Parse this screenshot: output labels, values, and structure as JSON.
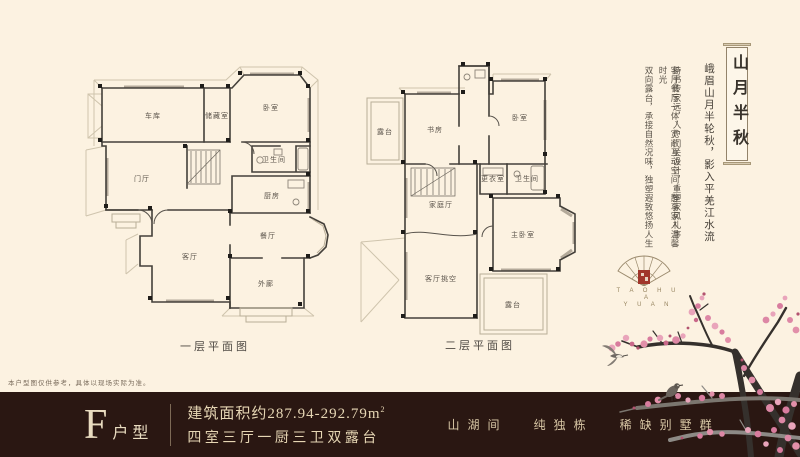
{
  "colors": {
    "background": "#fcf2e1",
    "bar_background": "#2a1712",
    "seal_red": "#a1362b",
    "gold_text": "#e6d6b4",
    "blossom_pink": "#dc7f9f"
  },
  "plans": [
    {
      "caption": "一层平面图",
      "rooms": [
        {
          "label": "车库",
          "x": 71,
          "y": 68
        },
        {
          "label": "储藏室",
          "x": 135,
          "y": 68
        },
        {
          "label": "卧室",
          "x": 189,
          "y": 60
        },
        {
          "label": "卫生间",
          "x": 192,
          "y": 112
        },
        {
          "label": "厨房",
          "x": 190,
          "y": 148
        },
        {
          "label": "门厅",
          "x": 60,
          "y": 131
        },
        {
          "label": "餐厅",
          "x": 186,
          "y": 188
        },
        {
          "label": "客厅",
          "x": 108,
          "y": 209
        },
        {
          "label": "外廊",
          "x": 184,
          "y": 236
        }
      ]
    },
    {
      "caption": "二层平面图",
      "rooms": [
        {
          "label": "露台",
          "x": 30,
          "y": 78
        },
        {
          "label": "书房",
          "x": 80,
          "y": 76
        },
        {
          "label": "卧室",
          "x": 165,
          "y": 64
        },
        {
          "label": "更衣室",
          "x": 138,
          "y": 125
        },
        {
          "label": "卫生间",
          "x": 172,
          "y": 125
        },
        {
          "label": "家庭厅",
          "x": 86,
          "y": 151
        },
        {
          "label": "主卧室",
          "x": 168,
          "y": 181
        },
        {
          "label": "客厅挑空",
          "x": 86,
          "y": 225
        },
        {
          "label": "露台",
          "x": 158,
          "y": 251
        }
      ]
    }
  ],
  "right_panel": {
    "title": "山月半秋",
    "poem": "峨眉山月半轮秋，影入平羌江水流",
    "columns": [
      "诗书传家远，入户门关设计，重塑家风礼序",
      "客厅餐厅一体，宽敞互动空间，静享家人温馨时光",
      "双向露台，承接自然况味，独塑遐致悠扬人生"
    ],
    "logo": {
      "line1": "T A O H U A",
      "line2": "Y U A N"
    }
  },
  "disclaimer": "本户型图仅供参考，具体以现场实际为准。",
  "bottom_bar": {
    "type_letter": "F",
    "type_suffix": "户型",
    "area_line": "建筑面积约287.94-292.79m",
    "area_sup": "2",
    "layout_line": "四室三厅一厨三卫双露台",
    "slogan": [
      "山湖间",
      "纯独栋",
      "稀缺别墅群"
    ]
  }
}
